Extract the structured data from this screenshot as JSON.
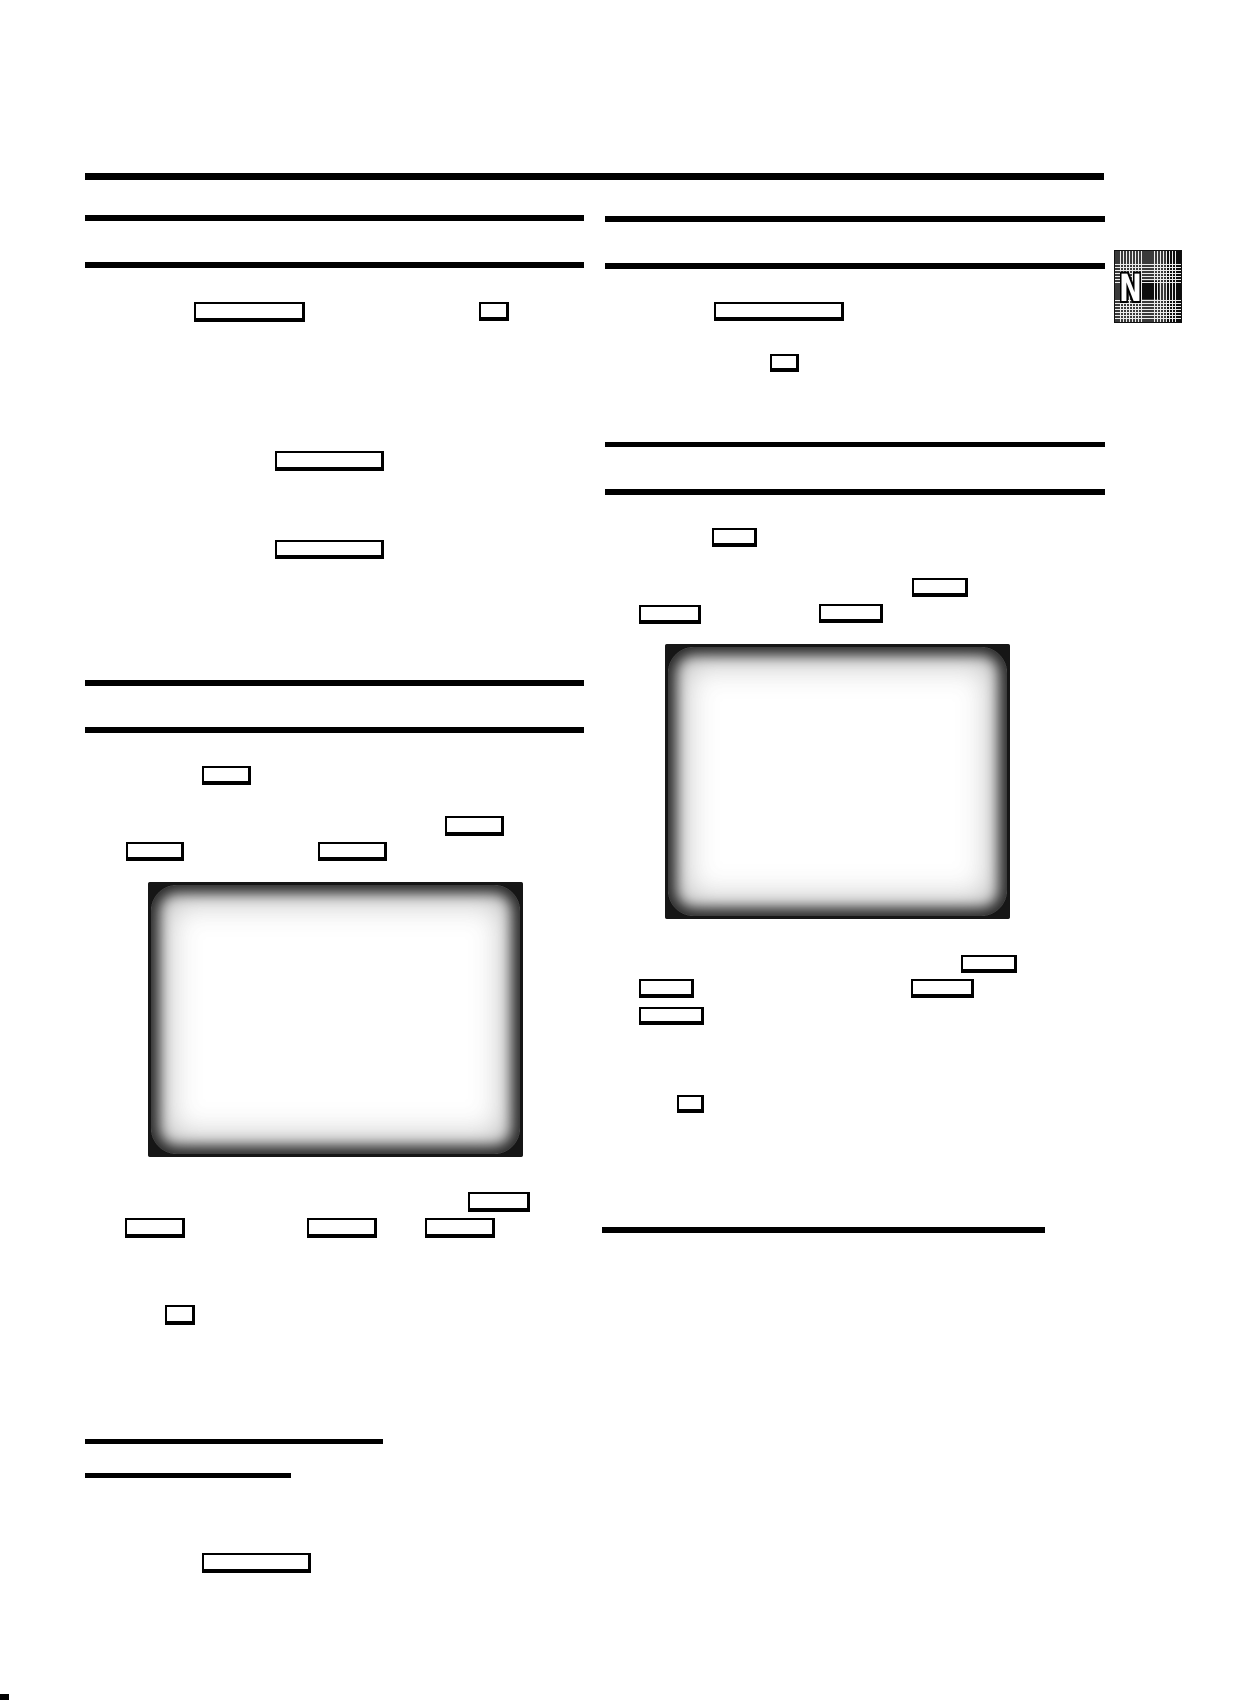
{
  "page": {
    "width": 1247,
    "height": 1701,
    "background": "#ffffff",
    "kind": "scanned-manual-page",
    "visible_text": "N"
  },
  "colors": {
    "rule": "#000000",
    "key_box_border": "#000000",
    "screen_border": "#161616",
    "screen_face": "#ffffff",
    "badge_background": "#3a3a3a",
    "badge_letter": "#ffffff"
  },
  "badge": {
    "letter": "N",
    "x": 1114,
    "y": 250,
    "w": 68,
    "h": 73
  },
  "rules": [
    {
      "id": "top-rule",
      "x": 85,
      "y": 173,
      "w": 1019,
      "h": 7
    },
    {
      "id": "left-heading1-rule-top",
      "x": 85,
      "y": 215,
      "w": 499,
      "h": 6
    },
    {
      "id": "left-heading1-rule-bottom",
      "x": 85,
      "y": 262,
      "w": 499,
      "h": 6
    },
    {
      "id": "right-heading1-rule-top",
      "x": 605,
      "y": 216,
      "w": 500,
      "h": 6
    },
    {
      "id": "right-heading1-rule-bottom",
      "x": 605,
      "y": 263,
      "w": 500,
      "h": 6
    },
    {
      "id": "right-heading2-rule-top",
      "x": 605,
      "y": 442,
      "w": 500,
      "h": 5
    },
    {
      "id": "right-heading2-rule-bottom",
      "x": 605,
      "y": 489,
      "w": 500,
      "h": 6
    },
    {
      "id": "left-heading2-rule-top",
      "x": 85,
      "y": 680,
      "w": 499,
      "h": 6
    },
    {
      "id": "left-heading2-rule-bottom",
      "x": 85,
      "y": 727,
      "w": 499,
      "h": 6
    },
    {
      "id": "right-section-end-rule",
      "x": 602,
      "y": 1227,
      "w": 443,
      "h": 6
    },
    {
      "id": "bottom-left-rule-long",
      "x": 85,
      "y": 1439,
      "w": 298,
      "h": 5
    },
    {
      "id": "bottom-left-rule-short",
      "x": 85,
      "y": 1473,
      "w": 206,
      "h": 5
    }
  ],
  "key_boxes": [
    {
      "id": "left-wide-key-1",
      "x": 194,
      "y": 302,
      "w": 111,
      "h": 20
    },
    {
      "id": "left-small-key-1",
      "x": 479,
      "y": 302,
      "w": 30,
      "h": 19
    },
    {
      "id": "left-wide-key-2",
      "x": 275,
      "y": 451,
      "w": 109,
      "h": 20
    },
    {
      "id": "left-wide-key-3",
      "x": 275,
      "y": 540,
      "w": 109,
      "h": 19
    },
    {
      "id": "left-key-4",
      "x": 202,
      "y": 766,
      "w": 49,
      "h": 19
    },
    {
      "id": "left-key-5",
      "x": 445,
      "y": 816,
      "w": 59,
      "h": 20
    },
    {
      "id": "left-key-6",
      "x": 126,
      "y": 842,
      "w": 58,
      "h": 19
    },
    {
      "id": "left-key-7",
      "x": 318,
      "y": 842,
      "w": 69,
      "h": 19
    },
    {
      "id": "left-key-8",
      "x": 468,
      "y": 1192,
      "w": 62,
      "h": 20
    },
    {
      "id": "left-key-9",
      "x": 125,
      "y": 1218,
      "w": 60,
      "h": 20
    },
    {
      "id": "left-key-10",
      "x": 307,
      "y": 1218,
      "w": 70,
      "h": 20
    },
    {
      "id": "left-key-11",
      "x": 425,
      "y": 1218,
      "w": 70,
      "h": 20
    },
    {
      "id": "left-small-key-2",
      "x": 165,
      "y": 1305,
      "w": 30,
      "h": 20
    },
    {
      "id": "left-wide-key-4",
      "x": 202,
      "y": 1553,
      "w": 109,
      "h": 20
    },
    {
      "id": "right-wide-key-1",
      "x": 714,
      "y": 302,
      "w": 130,
      "h": 19
    },
    {
      "id": "right-small-key-1",
      "x": 770,
      "y": 354,
      "w": 29,
      "h": 18
    },
    {
      "id": "right-key-2",
      "x": 712,
      "y": 528,
      "w": 45,
      "h": 19
    },
    {
      "id": "right-key-3",
      "x": 912,
      "y": 578,
      "w": 56,
      "h": 19
    },
    {
      "id": "right-key-4",
      "x": 639,
      "y": 605,
      "w": 62,
      "h": 19
    },
    {
      "id": "right-key-5",
      "x": 819,
      "y": 604,
      "w": 64,
      "h": 19
    },
    {
      "id": "right-key-6",
      "x": 961,
      "y": 955,
      "w": 56,
      "h": 18
    },
    {
      "id": "right-key-7",
      "x": 639,
      "y": 979,
      "w": 55,
      "h": 19
    },
    {
      "id": "right-key-8",
      "x": 911,
      "y": 979,
      "w": 63,
      "h": 19
    },
    {
      "id": "right-key-9",
      "x": 639,
      "y": 1007,
      "w": 65,
      "h": 18
    },
    {
      "id": "right-small-key-2",
      "x": 677,
      "y": 1095,
      "w": 27,
      "h": 18
    }
  ],
  "screens": [
    {
      "id": "left-tv-screen",
      "x": 148,
      "y": 882,
      "w": 375,
      "h": 275
    },
    {
      "id": "right-tv-screen",
      "x": 665,
      "y": 644,
      "w": 345,
      "h": 275
    }
  ],
  "marks": [
    {
      "id": "corner-print-mark",
      "x": 0,
      "y": 1694,
      "w": 9,
      "h": 6
    }
  ]
}
